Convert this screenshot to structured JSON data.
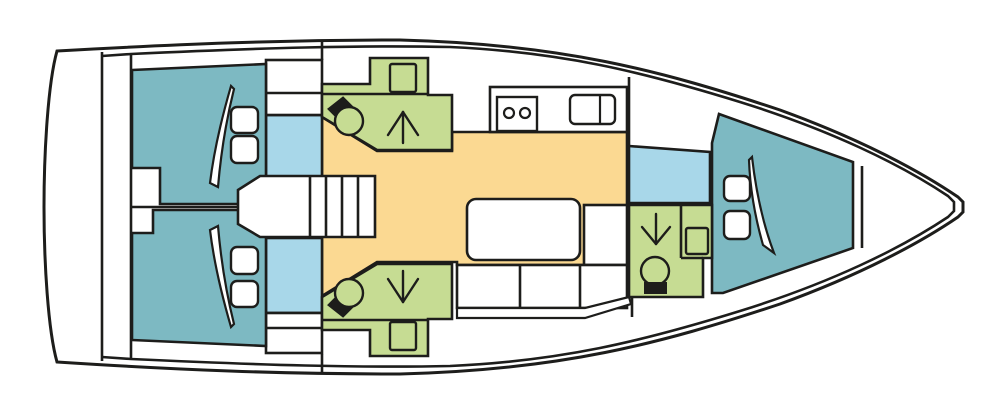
{
  "diagram": {
    "kind": "sailing-yacht-interior-floor-plan",
    "orientation": "bow-right-stern-left",
    "cabins": 3,
    "heads": 3
  },
  "palette": {
    "line": "#1d1d1b",
    "white": "#ffffff",
    "teal": "#7db9c2",
    "lightblue": "#a8d7e9",
    "green": "#c6dc93",
    "yellow": "#fbd992",
    "black": "#1d1d1b"
  },
  "canvas": {
    "width": 1004,
    "height": 413,
    "background": "#ffffff"
  },
  "shapes": [
    {
      "name": "hull-outline",
      "type": "path",
      "fill": "white",
      "sw": 3,
      "d": "M 57,51 C 180,44 280,40 400,40 C 560,44 660,70 780,110 C 860,139 920,171 958,197 L 963,202 L 963,212 L 958,217 C 920,243 860,275 780,304 C 660,344 560,370 400,374 C 280,374 180,370 57,362 C 48,330 44,262 44,207 C 44,152 48,83 57,51 Z"
    },
    {
      "name": "inner-deck-line",
      "type": "path",
      "fill": "none",
      "sw": 2.6,
      "d": "M 102,56 L 131,54 C 260,48 360,45 450,47 C 560,52 640,71 740,102 C 830,130 900,164 948,196 L 954,202 L 954,211 L 948,217 C 900,249 830,283 740,311 C 640,342 560,361 450,366 C 360,368 260,365 131,359 L 102,357"
    },
    {
      "name": "transom-platform-line",
      "type": "line",
      "x1": 102,
      "y1": 52,
      "x2": 102,
      "y2": 361
    },
    {
      "name": "aft-bulkhead-line",
      "type": "line",
      "x1": 131,
      "y1": 54,
      "x2": 131,
      "y2": 359
    },
    {
      "name": "aft-cabins-centerline",
      "type": "line",
      "x1": 131,
      "y1": 207,
      "x2": 240,
      "y2": 207
    },
    {
      "name": "deck-seam-top",
      "type": "line",
      "x1": 322,
      "y1": 41,
      "x2": 322,
      "y2": 60
    },
    {
      "name": "deck-seam-bottom",
      "type": "line",
      "x1": 322,
      "y1": 354,
      "x2": 322,
      "y2": 372
    },
    {
      "name": "galley-forward-bulkhead",
      "type": "line",
      "x1": 629,
      "y1": 77,
      "x2": 629,
      "y2": 146
    },
    {
      "name": "fwd-head-aft-bulkhead",
      "type": "line",
      "x1": 632,
      "y1": 297,
      "x2": 632,
      "y2": 317
    },
    {
      "name": "bow-locker-bulkhead",
      "type": "line",
      "x1": 862,
      "y1": 166,
      "x2": 862,
      "y2": 248
    },
    {
      "name": "salon-floor",
      "type": "polygon",
      "fill": "yellow",
      "pts": "322,117 377,151 452,151 452,132 627,132 627,265 457,265 457,262 377,262 322,296"
    },
    {
      "name": "corridor-port",
      "type": "rect",
      "fill": "lightblue",
      "x": 266,
      "y": 115,
      "w": 56,
      "h": 62
    },
    {
      "name": "corridor-starboard",
      "type": "rect",
      "fill": "lightblue",
      "x": 266,
      "y": 238,
      "w": 56,
      "h": 75
    },
    {
      "name": "fwd-shower-compartment",
      "type": "polygon",
      "fill": "lightblue",
      "pts": "629,146 710,152 710,203 629,203"
    },
    {
      "name": "locker-port",
      "type": "rect",
      "fill": "white",
      "x": 266,
      "y": 60,
      "w": 56,
      "h": 55
    },
    {
      "name": "locker-port-shelf-line",
      "type": "line",
      "x1": 266,
      "y1": 93,
      "x2": 322,
      "y2": 93
    },
    {
      "name": "locker-starboard",
      "type": "rect",
      "fill": "white",
      "x": 266,
      "y": 313,
      "w": 56,
      "h": 40
    },
    {
      "name": "locker-starboard-shelf-line",
      "type": "line",
      "x1": 266,
      "y1": 328,
      "x2": 322,
      "y2": 328
    },
    {
      "name": "head-aft-port",
      "type": "polygon",
      "fill": "green",
      "pts": "322,84 370,84 370,58 428,58 428,95 452,95 452,150 377,150 322,117"
    },
    {
      "name": "head-aft-port-counter-line",
      "type": "line",
      "x1": 322,
      "y1": 94,
      "x2": 428,
      "y2": 94
    },
    {
      "name": "head-aft-port-sink",
      "type": "rect",
      "fill": "none",
      "x": 390,
      "y": 64,
      "w": 26,
      "h": 28,
      "rx": 2,
      "sw": 2.4
    },
    {
      "name": "head-aft-port-toilet-tank",
      "type": "polygon",
      "fill": "black",
      "pts": "329,109 343,98 355,110 341,121"
    },
    {
      "name": "head-aft-port-toilet",
      "type": "circle",
      "fill": "green",
      "cx": 349,
      "cy": 121,
      "r": 14,
      "sw": 2.4
    },
    {
      "name": "head-aft-port-shower-stem",
      "type": "line",
      "x1": 403,
      "y1": 112,
      "x2": 403,
      "y2": 143,
      "cap": "round",
      "sw": 2.4
    },
    {
      "name": "head-aft-port-shower-leg-l",
      "type": "line",
      "x1": 403,
      "y1": 112,
      "x2": 388,
      "y2": 135,
      "cap": "round",
      "sw": 2.4
    },
    {
      "name": "head-aft-port-shower-leg-r",
      "type": "line",
      "x1": 403,
      "y1": 112,
      "x2": 418,
      "y2": 135,
      "cap": "round",
      "sw": 2.4
    },
    {
      "name": "head-aft-starboard",
      "type": "polygon",
      "fill": "green",
      "pts": "322,330 370,330 370,356 428,356 428,319 452,319 452,264 377,264 322,297"
    },
    {
      "name": "head-aft-starboard-counter-line",
      "type": "line",
      "x1": 322,
      "y1": 320,
      "x2": 428,
      "y2": 320
    },
    {
      "name": "head-aft-starboard-sink",
      "type": "rect",
      "fill": "none",
      "x": 390,
      "y": 322,
      "w": 26,
      "h": 28,
      "rx": 2,
      "sw": 2.4
    },
    {
      "name": "head-aft-starboard-toilet-tank",
      "type": "polygon",
      "fill": "black",
      "pts": "329,305 343,316 355,304 341,293"
    },
    {
      "name": "head-aft-starboard-toilet",
      "type": "circle",
      "fill": "green",
      "cx": 349,
      "cy": 293,
      "r": 14,
      "sw": 2.4
    },
    {
      "name": "head-aft-starboard-shower-stem",
      "type": "line",
      "x1": 403,
      "y1": 302,
      "x2": 403,
      "y2": 271,
      "cap": "round",
      "sw": 2.4
    },
    {
      "name": "head-aft-starboard-shower-leg-l",
      "type": "line",
      "x1": 403,
      "y1": 302,
      "x2": 388,
      "y2": 279,
      "cap": "round",
      "sw": 2.4
    },
    {
      "name": "head-aft-starboard-shower-leg-r",
      "type": "line",
      "x1": 403,
      "y1": 302,
      "x2": 418,
      "y2": 279,
      "cap": "round",
      "sw": 2.4
    },
    {
      "name": "galley-counter",
      "type": "rect",
      "fill": "white",
      "x": 490,
      "y": 87,
      "w": 137,
      "h": 45
    },
    {
      "name": "galley-stove",
      "type": "rect",
      "fill": "white",
      "x": 497,
      "y": 97,
      "w": 40,
      "h": 34,
      "sw": 2.4
    },
    {
      "name": "galley-burner-left",
      "type": "circle",
      "fill": "white",
      "cx": 509,
      "cy": 113,
      "r": 5,
      "sw": 2.2
    },
    {
      "name": "galley-burner-right",
      "type": "circle",
      "fill": "white",
      "cx": 525,
      "cy": 113,
      "r": 5,
      "sw": 2.2
    },
    {
      "name": "galley-sink",
      "type": "rect",
      "fill": "white",
      "x": 570,
      "y": 95,
      "w": 45,
      "h": 29,
      "rx": 5,
      "sw": 2.4
    },
    {
      "name": "galley-sink-divider",
      "type": "line",
      "x1": 600,
      "y1": 95,
      "x2": 600,
      "y2": 124,
      "sw": 2.2
    },
    {
      "name": "cabin-aft-port",
      "type": "polygon",
      "fill": "teal",
      "pts": "132,70 266,64 266,204 160,204 160,168 132,168"
    },
    {
      "name": "cabin-aft-starboard",
      "type": "polygon",
      "fill": "teal",
      "pts": "132,340 266,346 266,210 153,210 153,233 132,233"
    },
    {
      "name": "cabin-forward",
      "type": "polygon",
      "fill": "teal",
      "pts": "712,143 719,114 853,162 853,248 723,293 712,293"
    },
    {
      "name": "duvet-fold-aft-port",
      "type": "path",
      "fill": "white",
      "sw": 2.2,
      "d": "M 231,86 C 222,117 214,150 210,183 L 218,187 C 221,152 227,117 234,89 Z"
    },
    {
      "name": "duvet-fold-aft-starboard",
      "type": "path",
      "fill": "white",
      "sw": 2.2,
      "d": "M 231,327 C 222,296 214,263 210,230 L 218,226 C 221,261 227,296 234,324 Z"
    },
    {
      "name": "duvet-fold-forward",
      "type": "path",
      "fill": "white",
      "sw": 2.2,
      "d": "M 752,157 C 756,192 763,224 774,253 L 763,245 C 755,217 750,188 749,160 Z"
    },
    {
      "name": "pillow-aft-port-1",
      "type": "rect",
      "fill": "white",
      "x": 231,
      "y": 107,
      "w": 27,
      "h": 26,
      "rx": 6,
      "sw": 2.4
    },
    {
      "name": "pillow-aft-port-2",
      "type": "rect",
      "fill": "white",
      "x": 231,
      "y": 136,
      "w": 27,
      "h": 27,
      "rx": 6,
      "sw": 2.4
    },
    {
      "name": "pillow-aft-starboard-1",
      "type": "rect",
      "fill": "white",
      "x": 231,
      "y": 247,
      "w": 27,
      "h": 27,
      "rx": 6,
      "sw": 2.4
    },
    {
      "name": "pillow-aft-starboard-2",
      "type": "rect",
      "fill": "white",
      "x": 231,
      "y": 281,
      "w": 27,
      "h": 26,
      "rx": 6,
      "sw": 2.4
    },
    {
      "name": "pillow-forward-1",
      "type": "rect",
      "fill": "white",
      "x": 724,
      "y": 176,
      "w": 26,
      "h": 25,
      "rx": 6,
      "sw": 2.4
    },
    {
      "name": "pillow-forward-2",
      "type": "rect",
      "fill": "white",
      "x": 724,
      "y": 211,
      "w": 26,
      "h": 28,
      "rx": 6,
      "sw": 2.4
    },
    {
      "name": "companionway-stairs",
      "type": "polygon",
      "fill": "white",
      "pts": "238,190 260,176 375,176 375,237 260,237 238,224"
    },
    {
      "name": "stair-step-1",
      "type": "line",
      "x1": 310,
      "y1": 176,
      "x2": 310,
      "y2": 237
    },
    {
      "name": "stair-step-2",
      "type": "line",
      "x1": 326,
      "y1": 176,
      "x2": 326,
      "y2": 237
    },
    {
      "name": "stair-step-3",
      "type": "line",
      "x1": 342,
      "y1": 176,
      "x2": 342,
      "y2": 237
    },
    {
      "name": "stair-step-4",
      "type": "line",
      "x1": 358,
      "y1": 176,
      "x2": 358,
      "y2": 237
    },
    {
      "name": "salon-table",
      "type": "rect",
      "fill": "white",
      "x": 467,
      "y": 199,
      "w": 113,
      "h": 61,
      "rx": 9
    },
    {
      "name": "salon-bench-forward",
      "type": "rect",
      "fill": "white",
      "x": 584,
      "y": 205,
      "w": 43,
      "h": 60
    },
    {
      "name": "salon-settee",
      "type": "rect",
      "fill": "white",
      "x": 457,
      "y": 265,
      "w": 170,
      "h": 43
    },
    {
      "name": "settee-divider-1",
      "type": "line",
      "x1": 520,
      "y1": 265,
      "x2": 520,
      "y2": 308
    },
    {
      "name": "settee-divider-2",
      "type": "line",
      "x1": 580,
      "y1": 265,
      "x2": 580,
      "y2": 308
    },
    {
      "name": "settee-rail",
      "type": "polygon",
      "fill": "white",
      "sw": 2.2,
      "pts": "457,308 585,308 629,297 631,304 585,318 457,318"
    },
    {
      "name": "head-forward",
      "type": "polygon",
      "fill": "green",
      "pts": "629,205 712,205 712,258 703,258 703,297 629,297"
    },
    {
      "name": "head-forward-vanity-line",
      "type": "line",
      "x1": 681,
      "y1": 205,
      "x2": 681,
      "y2": 258
    },
    {
      "name": "head-forward-vanity-line2",
      "type": "line",
      "x1": 681,
      "y1": 258,
      "x2": 703,
      "y2": 258
    },
    {
      "name": "head-forward-sink",
      "type": "rect",
      "fill": "none",
      "x": 686,
      "y": 228,
      "w": 22,
      "h": 26,
      "rx": 2,
      "sw": 2.4
    },
    {
      "name": "head-forward-toilet",
      "type": "circle",
      "fill": "green",
      "cx": 655,
      "cy": 271,
      "r": 14,
      "sw": 2.4
    },
    {
      "name": "head-forward-toilet-tank",
      "type": "rect",
      "fill": "black",
      "x": 645,
      "y": 283,
      "w": 21,
      "h": 10,
      "sw": 2
    },
    {
      "name": "head-forward-shower-stem",
      "type": "line",
      "x1": 656,
      "y1": 214,
      "x2": 656,
      "y2": 244,
      "cap": "round",
      "sw": 2.4
    },
    {
      "name": "head-forward-shower-leg-l",
      "type": "line",
      "x1": 656,
      "y1": 244,
      "x2": 642,
      "y2": 227,
      "cap": "round",
      "sw": 2.4
    },
    {
      "name": "head-forward-shower-leg-r",
      "type": "line",
      "x1": 656,
      "y1": 244,
      "x2": 670,
      "y2": 227,
      "cap": "round",
      "sw": 2.4
    }
  ]
}
